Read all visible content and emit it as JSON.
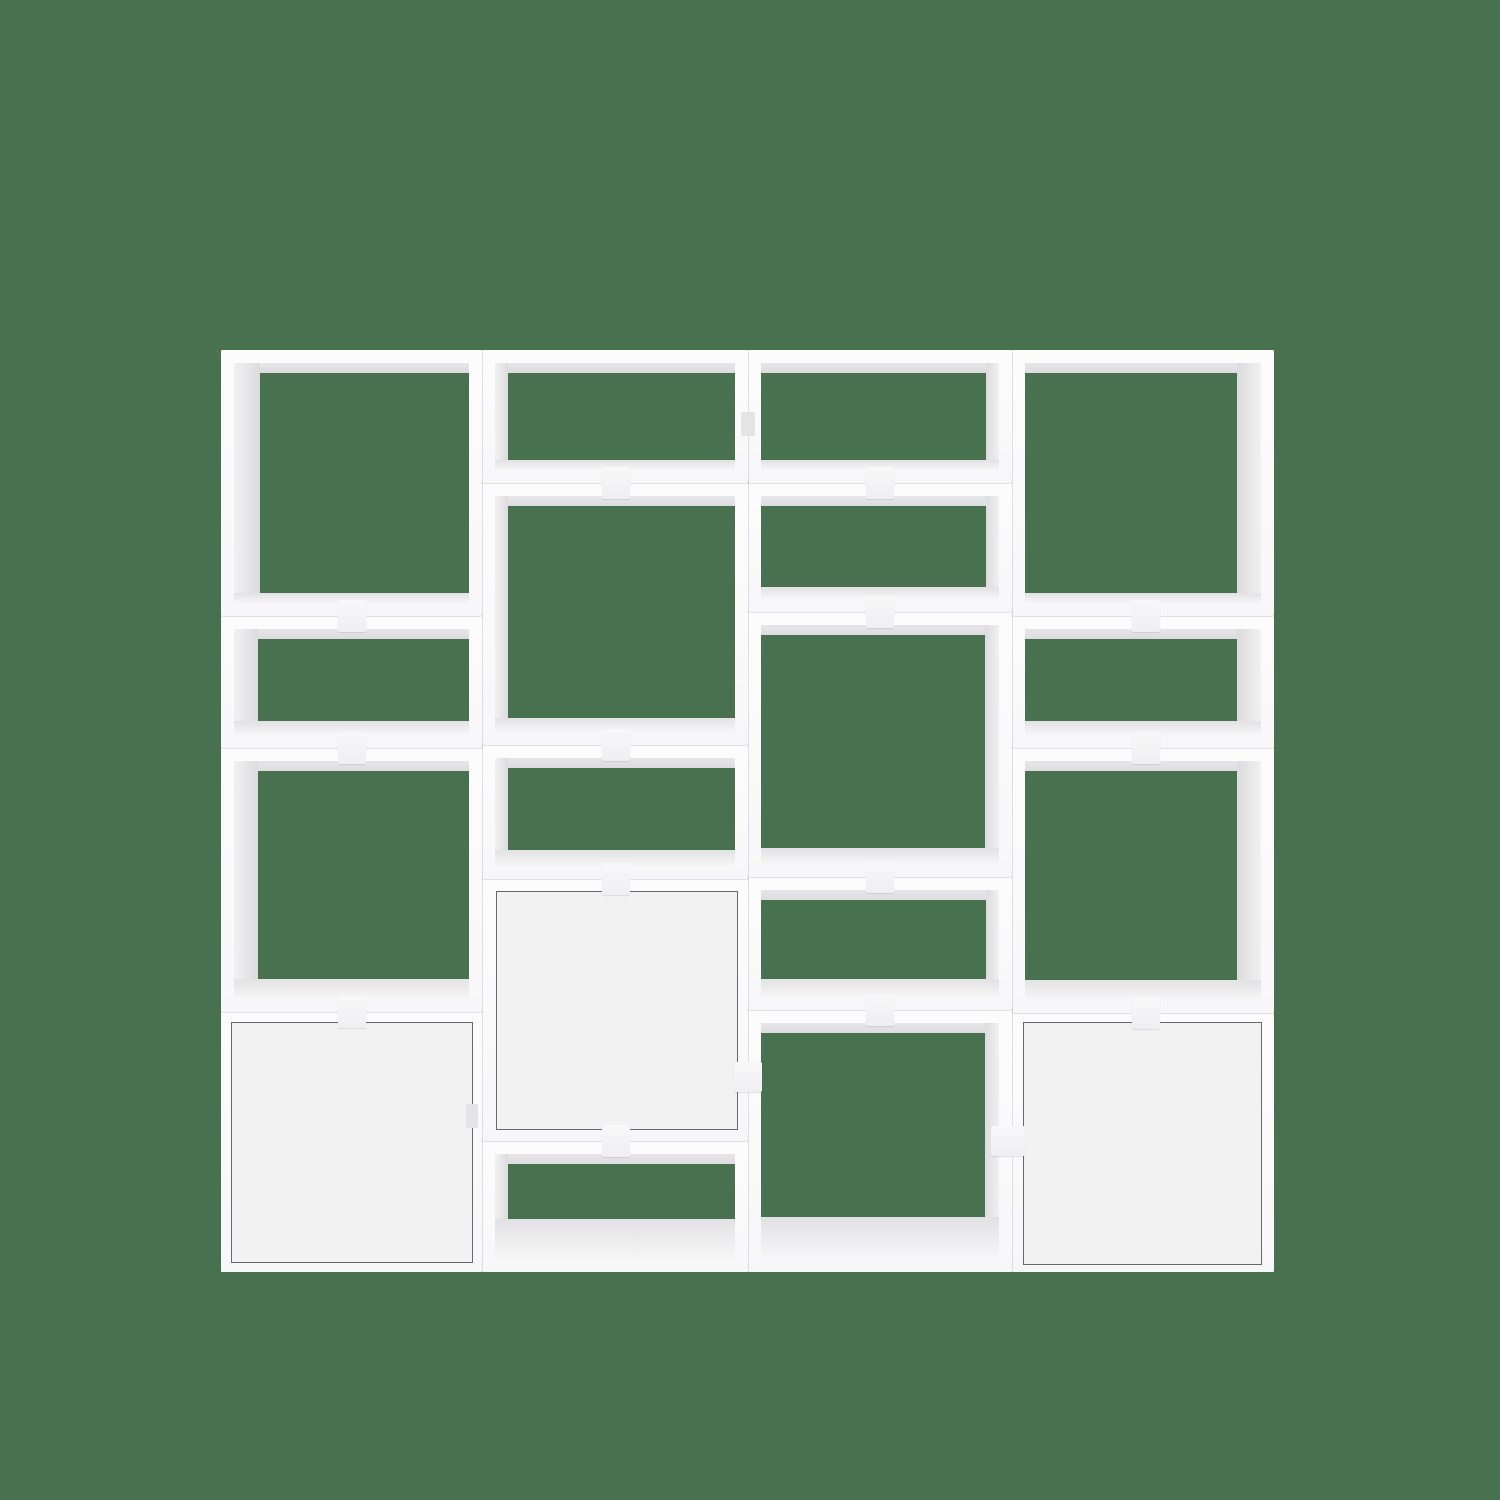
{
  "scene": {
    "kind": "product-photo",
    "subject": "white modular cube shelving unit with connector clips and three cabinet doors",
    "background_color": "#487150",
    "width": 1500,
    "height": 1500
  },
  "shelving": {
    "colors": {
      "frame": "#fbfbfc",
      "frame_gradient_bottom": "#f7f7f9",
      "cavity": "#487150",
      "ceiling": "#e7e7e9",
      "interior_wall_light": "#f1f1f2",
      "interior_wall_dark": "#dcdcde",
      "floor_light": "#f6f6f7",
      "floor_dark": "#e2e2e4",
      "door_fill": "#f2f2f3",
      "door_outline": "#69696c",
      "clip": "#f8f8f9",
      "clip_gradient_bottom": "#efeff1",
      "seam": "rgba(120,120,126,0.20)",
      "slot": "#e4e4e7"
    },
    "geometry": {
      "top": 350,
      "bottom": 1272,
      "wall": 13,
      "ceiling_depth": 10,
      "clip_w": 28,
      "clip_h": 32,
      "columns": [
        {
          "x": 221,
          "w": 261,
          "modules": [
            {
              "t": "open",
              "y0": 350,
              "y1": 616,
              "side": "left",
              "sw": 26,
              "fl": 10
            },
            {
              "t": "open",
              "y0": 616,
              "y1": 748,
              "side": "left",
              "sw": 24,
              "fl": 14
            },
            {
              "t": "open",
              "y0": 748,
              "y1": 1012,
              "side": "left",
              "sw": 24,
              "fl": 20
            },
            {
              "t": "door",
              "y0": 1012,
              "y1": 1272,
              "inset": [
                10,
                10,
                9,
                9
              ]
            }
          ]
        },
        {
          "x": 482,
          "w": 266,
          "modules": [
            {
              "t": "open",
              "y0": 350,
              "y1": 483,
              "side": "left",
              "sw": 13,
              "fl": 10
            },
            {
              "t": "open",
              "y0": 483,
              "y1": 745,
              "side": "left",
              "sw": 13,
              "fl": 14
            },
            {
              "t": "open",
              "y0": 745,
              "y1": 879,
              "side": "left",
              "sw": 13,
              "fl": 16
            },
            {
              "t": "door",
              "y0": 879,
              "y1": 1141,
              "inset": [
                14,
                12,
                10,
                11
              ]
            },
            {
              "t": "open",
              "y0": 1141,
              "y1": 1272,
              "side": "left",
              "sw": 13,
              "fl": 40
            }
          ]
        },
        {
          "x": 748,
          "w": 264,
          "modules": [
            {
              "t": "open",
              "y0": 350,
              "y1": 483,
              "side": "right",
              "sw": 13,
              "fl": 10
            },
            {
              "t": "open",
              "y0": 483,
              "y1": 612,
              "side": "right",
              "sw": 13,
              "fl": 12
            },
            {
              "t": "open",
              "y0": 612,
              "y1": 877,
              "side": "right",
              "sw": 14,
              "fl": 16
            },
            {
              "t": "open",
              "y0": 877,
              "y1": 1010,
              "side": "right",
              "sw": 13,
              "fl": 18
            },
            {
              "t": "open",
              "y0": 1010,
              "y1": 1272,
              "side": "right",
              "sw": 14,
              "fl": 42
            }
          ]
        },
        {
          "x": 1012,
          "w": 262,
          "modules": [
            {
              "t": "open",
              "y0": 350,
              "y1": 616,
              "side": "right",
              "sw": 24,
              "fl": 10
            },
            {
              "t": "open",
              "y0": 616,
              "y1": 748,
              "side": "right",
              "sw": 24,
              "fl": 14
            },
            {
              "t": "open",
              "y0": 748,
              "y1": 1013,
              "side": "right",
              "sw": 24,
              "fl": 20
            },
            {
              "t": "door",
              "y0": 1013,
              "y1": 1272,
              "inset": [
                11,
                9,
                12,
                7
              ]
            }
          ]
        }
      ],
      "seam_xs": [
        482,
        748,
        1012
      ],
      "clips": [
        [
          352,
          616
        ],
        [
          352,
          748
        ],
        [
          352,
          1012
        ],
        [
          616,
          483
        ],
        [
          616,
          745
        ],
        [
          616,
          879
        ],
        [
          616,
          1141
        ],
        [
          880,
          483
        ],
        [
          880,
          612
        ],
        [
          880,
          877
        ],
        [
          880,
          1010
        ],
        [
          1146,
          616
        ],
        [
          1146,
          748
        ],
        [
          1146,
          1013
        ]
      ],
      "side_clips": [
        {
          "x": 734,
          "y": 1062,
          "w": 28,
          "h": 30,
          "subtle": false
        },
        {
          "x": 991,
          "y": 1126,
          "w": 34,
          "h": 30,
          "subtle": false
        },
        {
          "x": 741,
          "y": 412,
          "w": 14,
          "h": 24,
          "subtle": true
        },
        {
          "x": 466,
          "y": 1104,
          "w": 12,
          "h": 24,
          "subtle": true
        }
      ]
    }
  }
}
